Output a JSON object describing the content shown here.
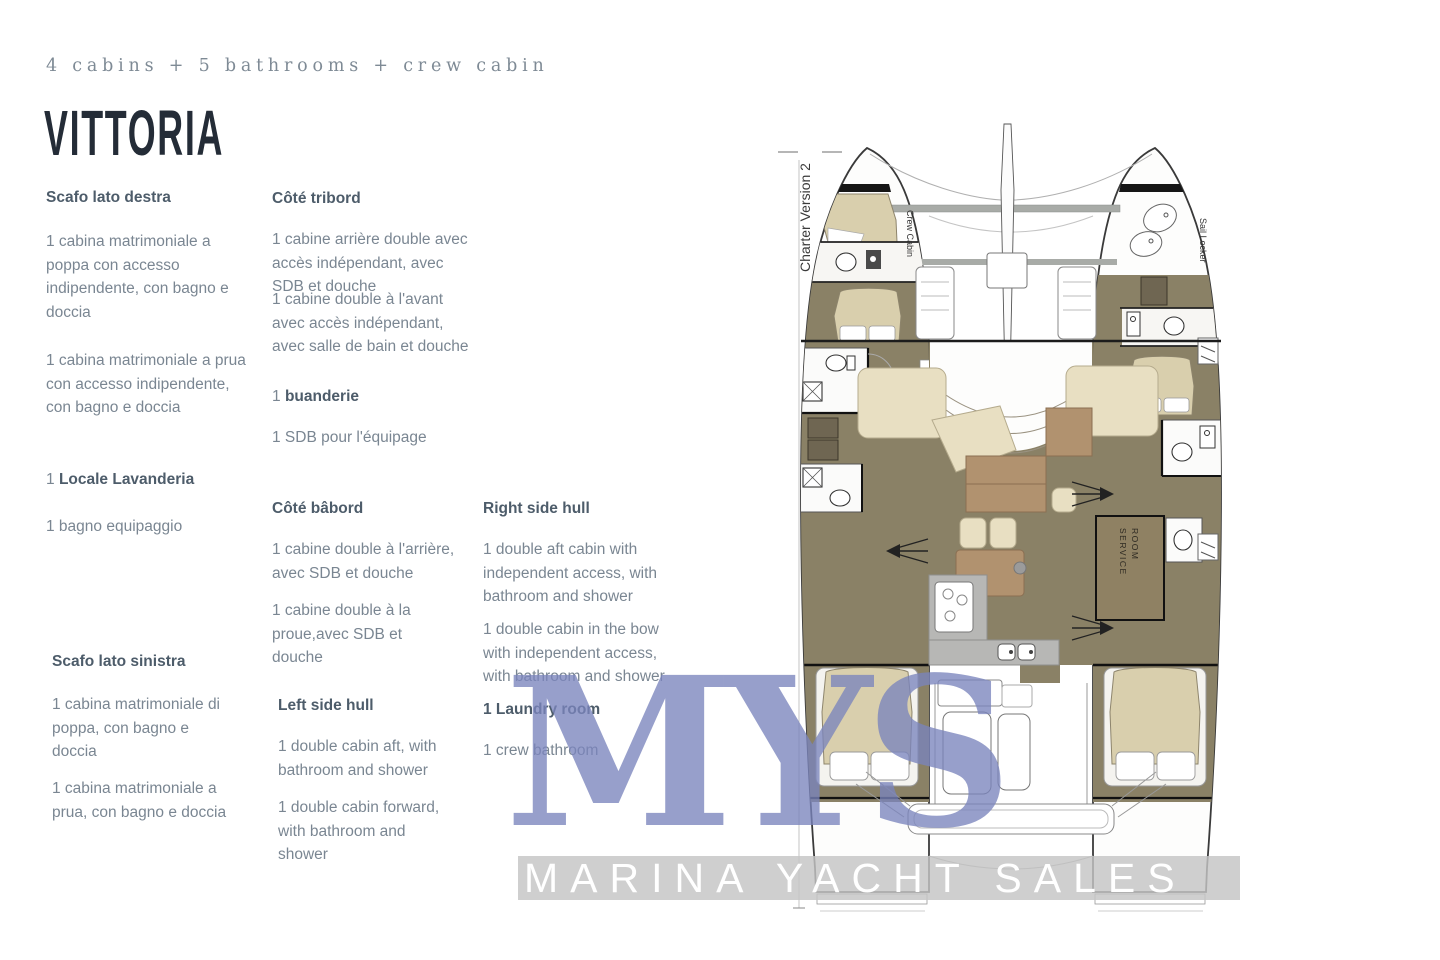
{
  "page": {
    "subtitle": "4 cabins + 5 bathrooms + crew cabin",
    "title": "VITTORIA"
  },
  "col_it": {
    "h1": "Scafo lato destra",
    "p1": "1 cabina matrimoniale a poppa con accesso indipendente, con bagno e doccia",
    "p2": "1 cabina matrimoniale a prua con accesso indipendente, con bagno e doccia",
    "p3_prefix": "1 ",
    "p3_bold": "Locale Lavanderia",
    "p4": "1 bagno equipaggio",
    "h2": "Scafo lato sinistra",
    "p5": "1 cabina matrimoniale di poppa, con bagno e doccia",
    "p6": "1 cabina matrimoniale a prua, con bagno e doccia"
  },
  "col_fr": {
    "h1": "Côté tribord",
    "p1": "1 cabine arrière double avec accès indépendant, avec SDB et douche",
    "p2": "1 cabine double à l'avant avec accès indépendant, avec salle de bain et douche",
    "p3_prefix": "1 ",
    "p3_bold": "buanderie",
    "p4": "1 SDB pour l'équipage",
    "h2": "Côté bâbord",
    "p5": "1 cabine double à l'arrière, avec SDB et douche",
    "p6": "1 cabine double à la proue,avec SDB et douche",
    "h3": "Left side hull",
    "p7": "1 double cabin aft, with bathroom and shower",
    "p8": "1 double cabin forward, with bathroom and shower"
  },
  "col_en": {
    "h1": "Right side hull",
    "p1": "1 double aft cabin with independent access, with bathroom and shower",
    "p2": "1 double cabin in the bow with independent access, with bathroom and shower",
    "p3": "1 Laundry room",
    "p4": "1 crew bathroom"
  },
  "diagram": {
    "version_label": "Charter Version 2",
    "crew_cabin_label": "Crew Cabin",
    "sail_locker_label": "Sail Locker",
    "service_room_line1": "SERVICE",
    "service_room_line2": "ROOM"
  },
  "watermark": {
    "logo": "MYS",
    "tagline": "MARINA YACHT SALES"
  },
  "colors": {
    "heading": "#4d5c6a",
    "body_text": "#7a8692",
    "title_text": "#242c37",
    "watermark_blue": "#7a84bc",
    "plan_olive": "#8a8166",
    "plan_tan": "#d9cfad",
    "plan_cream": "#e8dfc2",
    "plan_brown": "#b1926f"
  }
}
